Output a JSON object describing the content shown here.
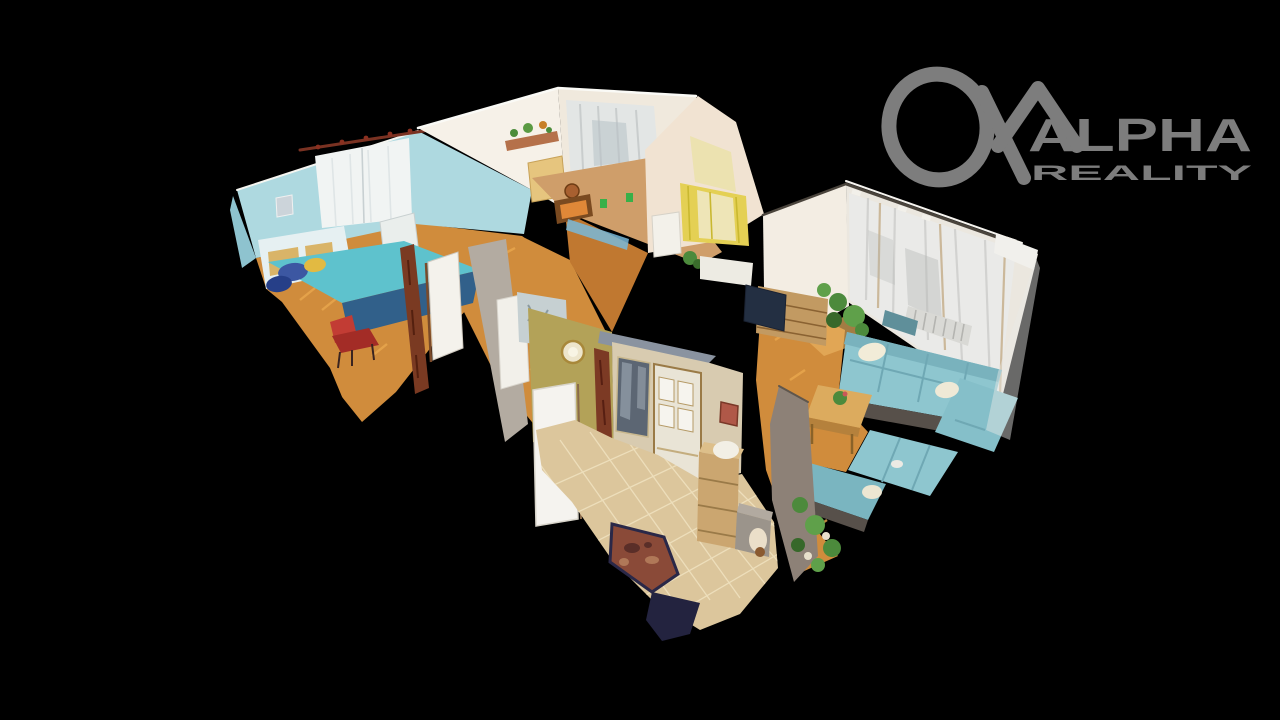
{
  "watermark": {
    "brand_line1": "ALPHA",
    "brand_line2": "REALITY",
    "color": "#7d7d7d"
  },
  "scene": {
    "type": "3d-dollhouse-cutaway",
    "description": "Top-down cutaway 3D scan of an apartment: blue bedroom with daybed, white kitchen with sheer curtains, child room with yellow curtains, central hallway, living room with teal corner sofa, tiled entrance hall"
  },
  "palette": {
    "background": "#000000",
    "blue_wall": "#aed9e0",
    "bed_teal": "#5ec2cd",
    "white_wall": "#f6f1e8",
    "tan_wall": "#cf9e6a",
    "olive_wall": "#b3a258",
    "pink_wall": "#f1e3d2",
    "yellow_curtain": "#e4d054",
    "cream_wall": "#f3ede3",
    "curtain_wall": "#ebe7df",
    "curtain_gray": "#eaeae8",
    "parquet": "#d08c3c",
    "tile_floor": "#dcc69c",
    "sofa_teal": "#8ec6cf",
    "sofa_base": "#57504a",
    "wood_cabinet": "#c29a62",
    "chest_wood": "#cba670",
    "table_wood": "#dcab5e",
    "rug_red": "#8a4a38",
    "mat_navy": "#23233f",
    "gray_wall": "#8d8177",
    "beige_wall": "#d8cbb0",
    "plant_green": "#4c8a3c",
    "red_chair": "#a32c26"
  }
}
